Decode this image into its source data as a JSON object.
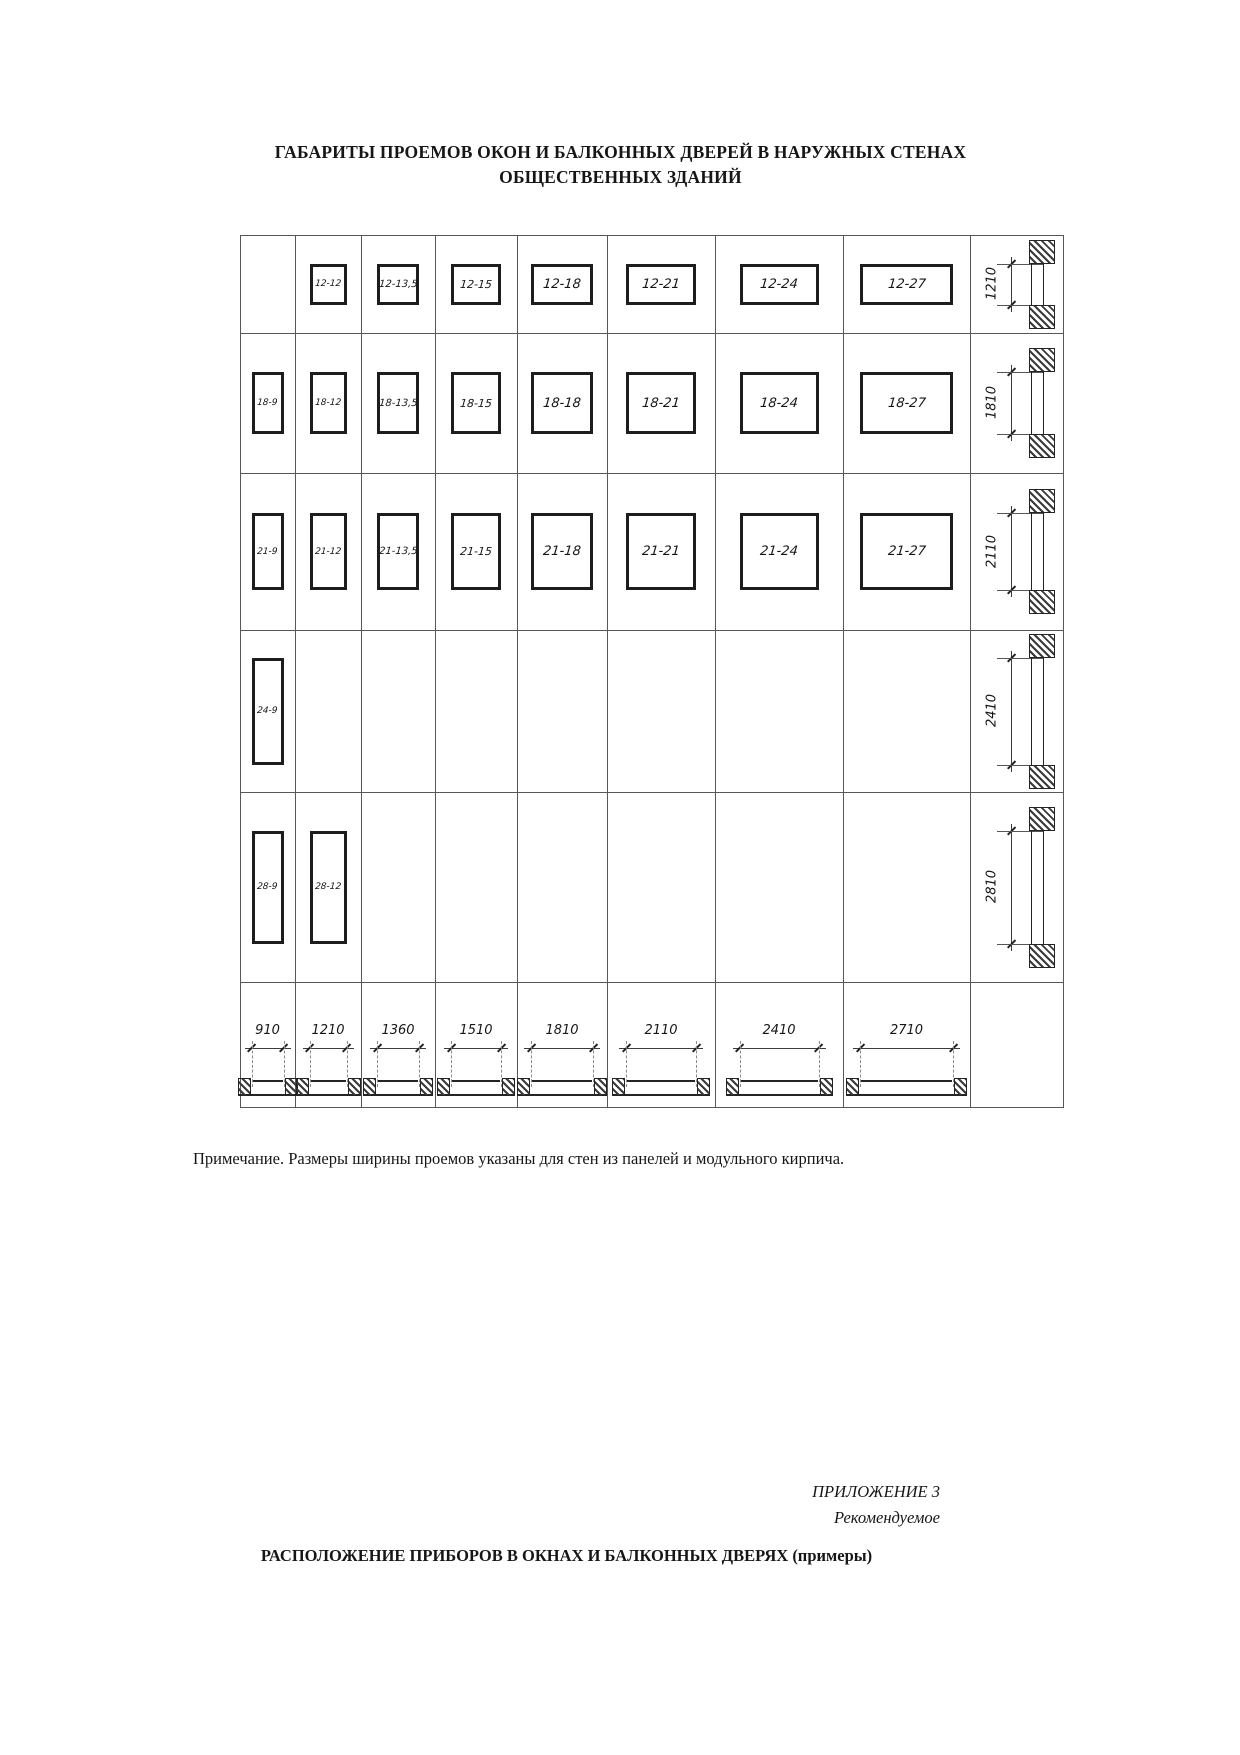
{
  "title": {
    "line1": "ГАБАРИТЫ ПРОЕМОВ ОКОН И БАЛКОННЫХ ДВЕРЕЙ В НАРУЖНЫХ СТЕНАХ",
    "line2": "ОБЩЕСТВЕННЫХ ЗДАНИЙ"
  },
  "table": {
    "rows": [
      {
        "height_label": "1210",
        "cells": [
          "",
          "12-12",
          "12-13,5",
          "12-15",
          "12-18",
          "12-21",
          "12-24",
          "12-27"
        ]
      },
      {
        "height_label": "1810",
        "cells": [
          "18-9",
          "18-12",
          "18-13,5",
          "18-15",
          "18-18",
          "18-21",
          "18-24",
          "18-27"
        ]
      },
      {
        "height_label": "2110",
        "cells": [
          "21-9",
          "21-12",
          "21-13,5",
          "21-15",
          "21-18",
          "21-21",
          "21-24",
          "21-27"
        ]
      },
      {
        "height_label": "2410",
        "cells": [
          "24-9",
          "",
          "",
          "",
          "",
          "",
          "",
          ""
        ]
      },
      {
        "height_label": "2810",
        "cells": [
          "28-9",
          "28-12",
          "",
          "",
          "",
          "",
          "",
          ""
        ]
      }
    ],
    "width_labels": [
      "910",
      "1210",
      "1360",
      "1510",
      "1810",
      "2110",
      "2410",
      "2710"
    ]
  },
  "note": "Примечание. Размеры ширины проемов указаны для стен из панелей и модульного кирпича.",
  "appendix": {
    "line1": "ПРИЛОЖЕНИЕ 3",
    "line2": "Рекомендуемое"
  },
  "heading2": "РАСПОЛОЖЕНИЕ ПРИБОРОВ В ОКНАХ И БАЛКОННЫХ ДВЕРЯХ (примеры)"
}
